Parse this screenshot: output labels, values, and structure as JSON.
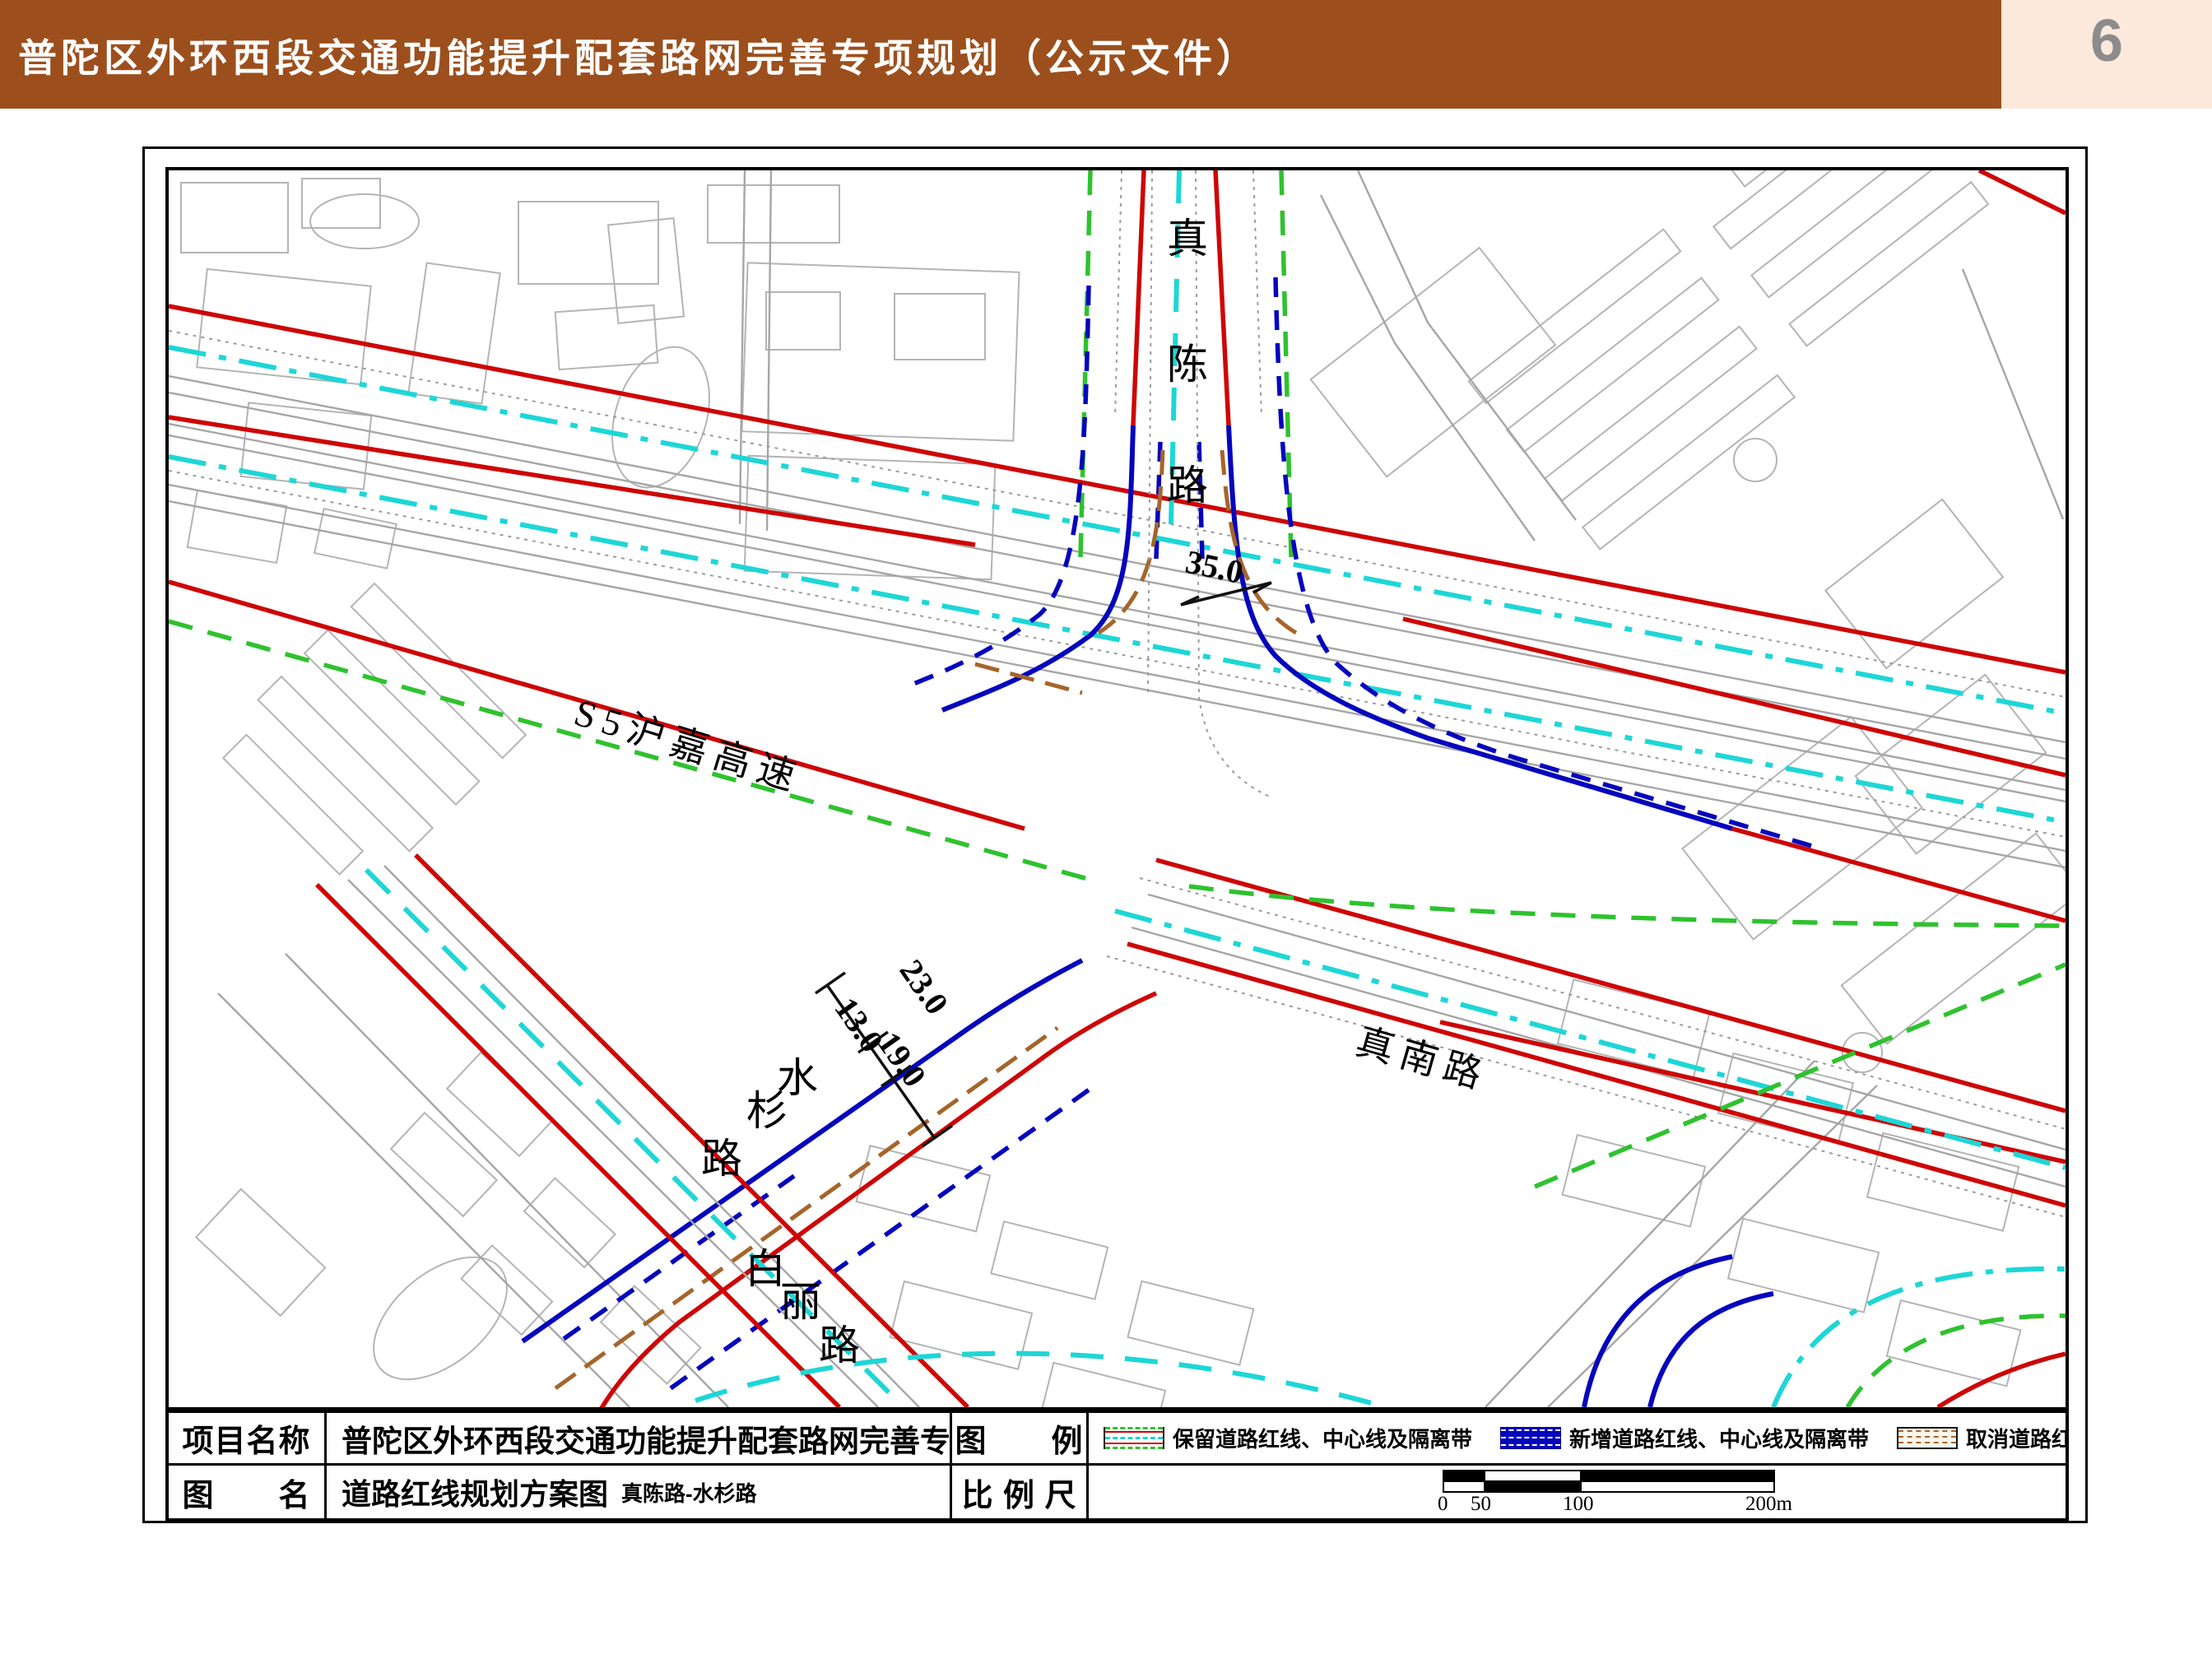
{
  "header": {
    "title": "普陀区外环西段交通功能提升配套路网完善专项规划（公示文件）",
    "page_number": "6"
  },
  "map": {
    "labels": {
      "zhenchen": {
        "name": "真陈路",
        "chars": [
          "真",
          "陈",
          "路"
        ]
      },
      "s5": {
        "name": "S5沪嘉高速"
      },
      "zhennan": {
        "name": "真南路"
      },
      "shuishan": {
        "name": "水杉路",
        "chars": [
          "水",
          "杉",
          "路"
        ]
      },
      "baili": {
        "name": "白丽路",
        "chars": [
          "白",
          "丽",
          "路"
        ]
      }
    },
    "dimensions": {
      "zhenchen_width": "35.0",
      "shuishan_w1": "23.0",
      "shuishan_w2": "13.0",
      "shuishan_w3": "19.0"
    }
  },
  "table": {
    "project_label": "项目名称",
    "project_name": "普陀区外环西段交通功能提升配套路网完善专项规划",
    "drawing_label": "图　　名",
    "drawing_name": "道路红线规划方案图",
    "drawing_sub": "真陈路-水杉路",
    "legend_label": "图　　例",
    "scale_label": "比 例 尺",
    "legend_items": [
      {
        "name": "保留道路红线、中心线及隔离带",
        "type": "keep"
      },
      {
        "name": "新增道路红线、中心线及隔离带",
        "type": "new"
      },
      {
        "name": "取消道路红线、中心线及隔离带",
        "type": "cancel"
      }
    ],
    "scale_ticks": {
      "t0": "0",
      "t50": "50",
      "t100": "100",
      "t200": "200m"
    }
  },
  "colors": {
    "header_brown": "#9c4f1c",
    "page_box": "#fce9dc",
    "page_number_gray": "#8c8c8c",
    "keep_red": "#ce0505",
    "new_blue": "#0505bd",
    "center_cyan": "#1ed6d6",
    "green_dash": "#2ec22e",
    "cancel_brown": "#a5652a",
    "building_gray": "#b4b4b4"
  }
}
